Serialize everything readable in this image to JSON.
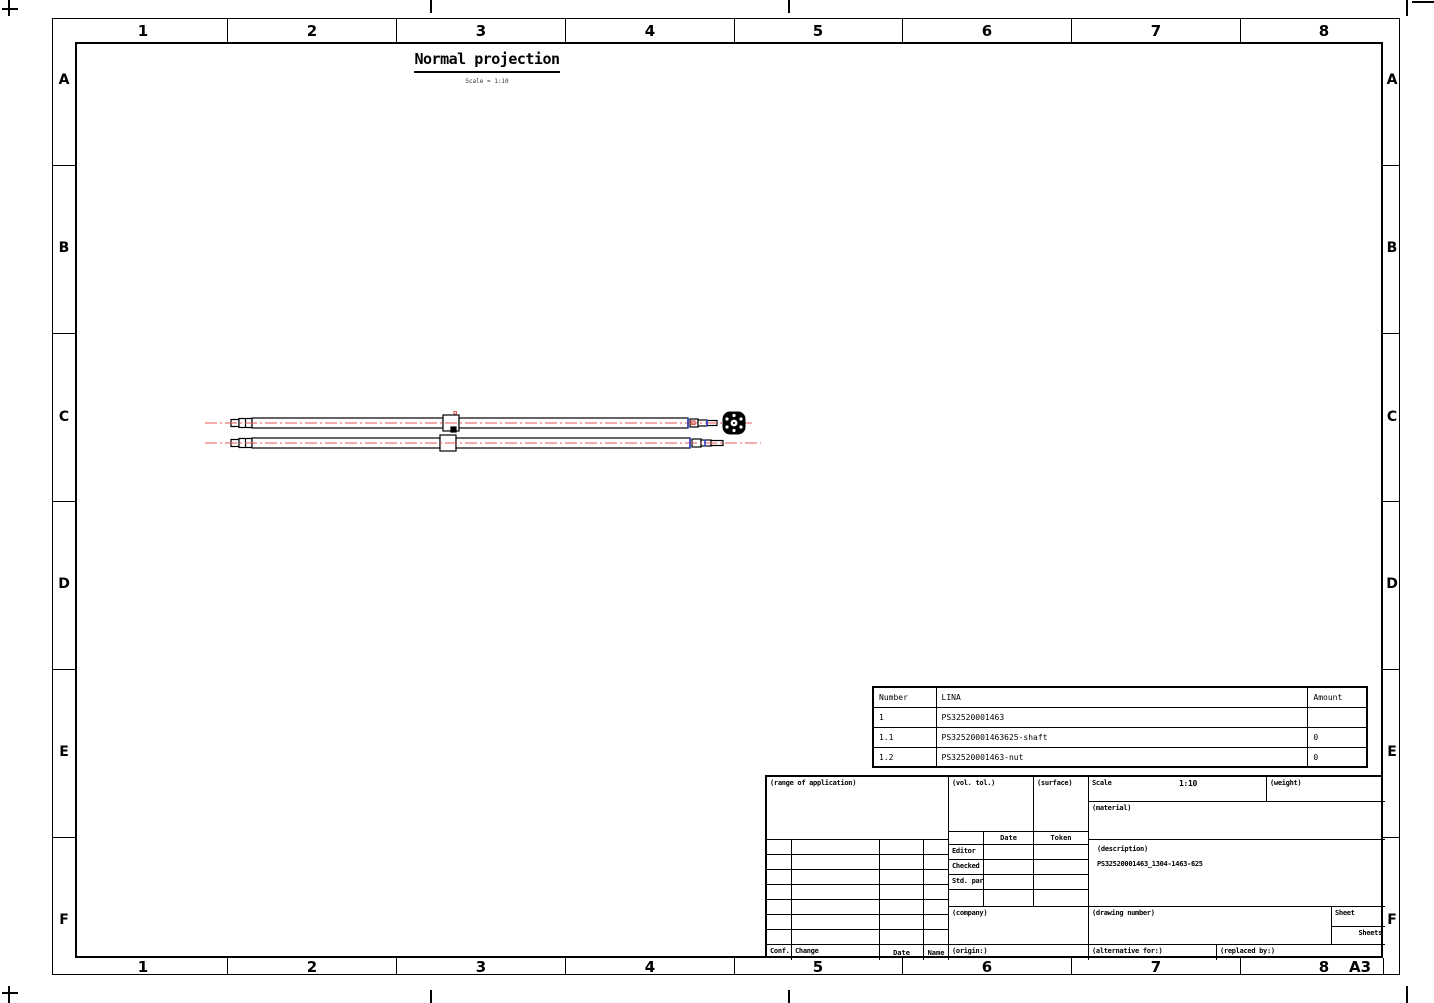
{
  "sheet": {
    "format": "A3",
    "zone_columns": [
      "1",
      "2",
      "3",
      "4",
      "5",
      "6",
      "7",
      "8"
    ],
    "zone_rows": [
      "A",
      "B",
      "C",
      "D",
      "E",
      "F"
    ]
  },
  "view": {
    "title": "Normal projection",
    "subtitle": "Scale = 1:10"
  },
  "parts_table": {
    "headers": {
      "number": "Number",
      "name": "LINA",
      "amount": "Amount"
    },
    "rows": [
      {
        "number": "1",
        "name": "PS32520001463",
        "amount": ""
      },
      {
        "number": "1.1",
        "name": "PS32520001463625-shaft",
        "amount": "0"
      },
      {
        "number": "1.2",
        "name": "PS32520001463-nut",
        "amount": "0"
      }
    ]
  },
  "title_block": {
    "range_of_application_label": "(range of application)",
    "vol_tol_label": "(vol. tol.)",
    "surface_label": "(surface)",
    "scale_label": "Scale",
    "scale_value": "1:10",
    "weight_label": "(weight)",
    "material_label": "(material)",
    "description_label": "(description)",
    "description_value": "PS32520001463_1304-1463-625",
    "date_col_label": "Date",
    "token_col_label": "Token",
    "editor_label": "Editor",
    "checked_label": "Checked",
    "std_part_label": "Std. part",
    "company_label": "(company)",
    "origin_label": "(origin:)",
    "drawing_number_label": "(drawing number)",
    "sheet_label": "Sheet",
    "sheets_label": "Sheets",
    "alternative_for_label": "(alternative for:)",
    "replaced_by_label": "(replaced by:)",
    "conf_label": "Conf.",
    "change_label": "Change",
    "date_label": "Date",
    "name_label": "Name"
  },
  "colors": {
    "centerline_red": "#e05a55",
    "detail_blue": "#2838c8",
    "line_black": "#000000",
    "background": "#ffffff"
  }
}
